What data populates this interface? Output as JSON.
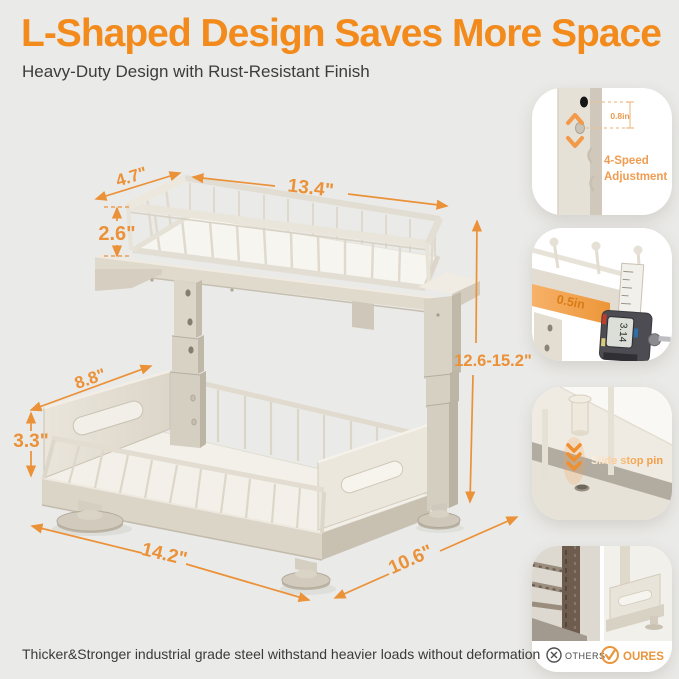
{
  "page": {
    "background": "#EAEAE8",
    "accent_orange": "#F28A1C",
    "dim_orange": "#EB9138"
  },
  "header": {
    "title": "L-Shaped Design Saves More Space",
    "subtitle": "Heavy-Duty Design with Rust-Resistant Finish"
  },
  "diagram": {
    "dimensions": {
      "top_depth": "4.7\"",
      "top_length": "13.4\"",
      "top_basket_height": "2.6\"",
      "side_panel_length": "8.8\"",
      "side_panel_height": "3.3\"",
      "base_length": "14.2\"",
      "base_depth": "10.6\"",
      "height_range": "12.6-15.2\""
    }
  },
  "callouts": {
    "adjustment": {
      "hole_spacing": "0.8in",
      "label_line1": "4-Speed",
      "label_line2": "Adjustment"
    },
    "thickness": {
      "measure": "0.5in",
      "caliper_reading": "3.14"
    },
    "pin": {
      "label": "Slide stop pin"
    },
    "comparison": {
      "others_label": "OTHERS",
      "ours_label": "OURES"
    }
  },
  "footer": {
    "text": "Thicker&Stronger industrial grade steel withstand heavier loads without deformation"
  }
}
